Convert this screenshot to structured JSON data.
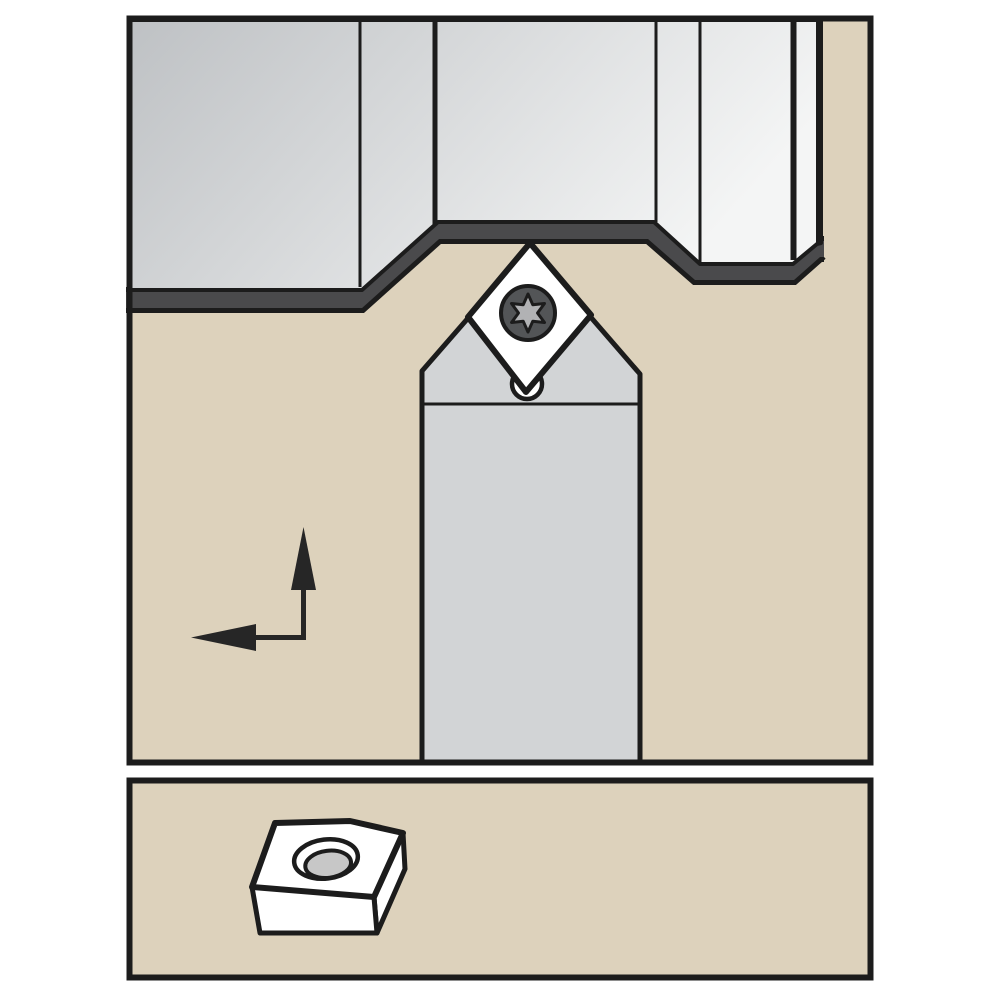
{
  "figure": {
    "kind": "technical-illustration",
    "main_view": "toolholder with diamond insert turning a stepped workpiece profile",
    "detail_view": "indexable diamond insert with center clamping hole, 3D view",
    "components": [
      "workpiece",
      "machined-surface-band",
      "toolholder-shank",
      "toolholder-head",
      "diamond-insert",
      "torx-clamp-screw",
      "clamp-pin-hole",
      "feed-direction-arrow",
      "insert-3d-detail"
    ]
  },
  "icons": [
    {
      "name": "torx-screw-icon",
      "glyph": "6-lobe star in circle"
    },
    {
      "name": "feed-direction-arrow-icon",
      "glyph": "up-then-left corner arrows"
    }
  ],
  "colors": {
    "background": "#ffffff",
    "panel_fill": "#ddd2bc",
    "line": "#1c1c1c",
    "workpiece_dark": "#bec1c4",
    "workpiece_light": "#f4f5f5",
    "cut_band": "#4a4a4c",
    "holder_fill": "#d2d4d6",
    "insert_fill": "#ffffff",
    "screw_ring": "#535557",
    "screw_star": "#b1b2b4",
    "hole_inner": "#c7c7c7",
    "arrow": "#262626"
  }
}
